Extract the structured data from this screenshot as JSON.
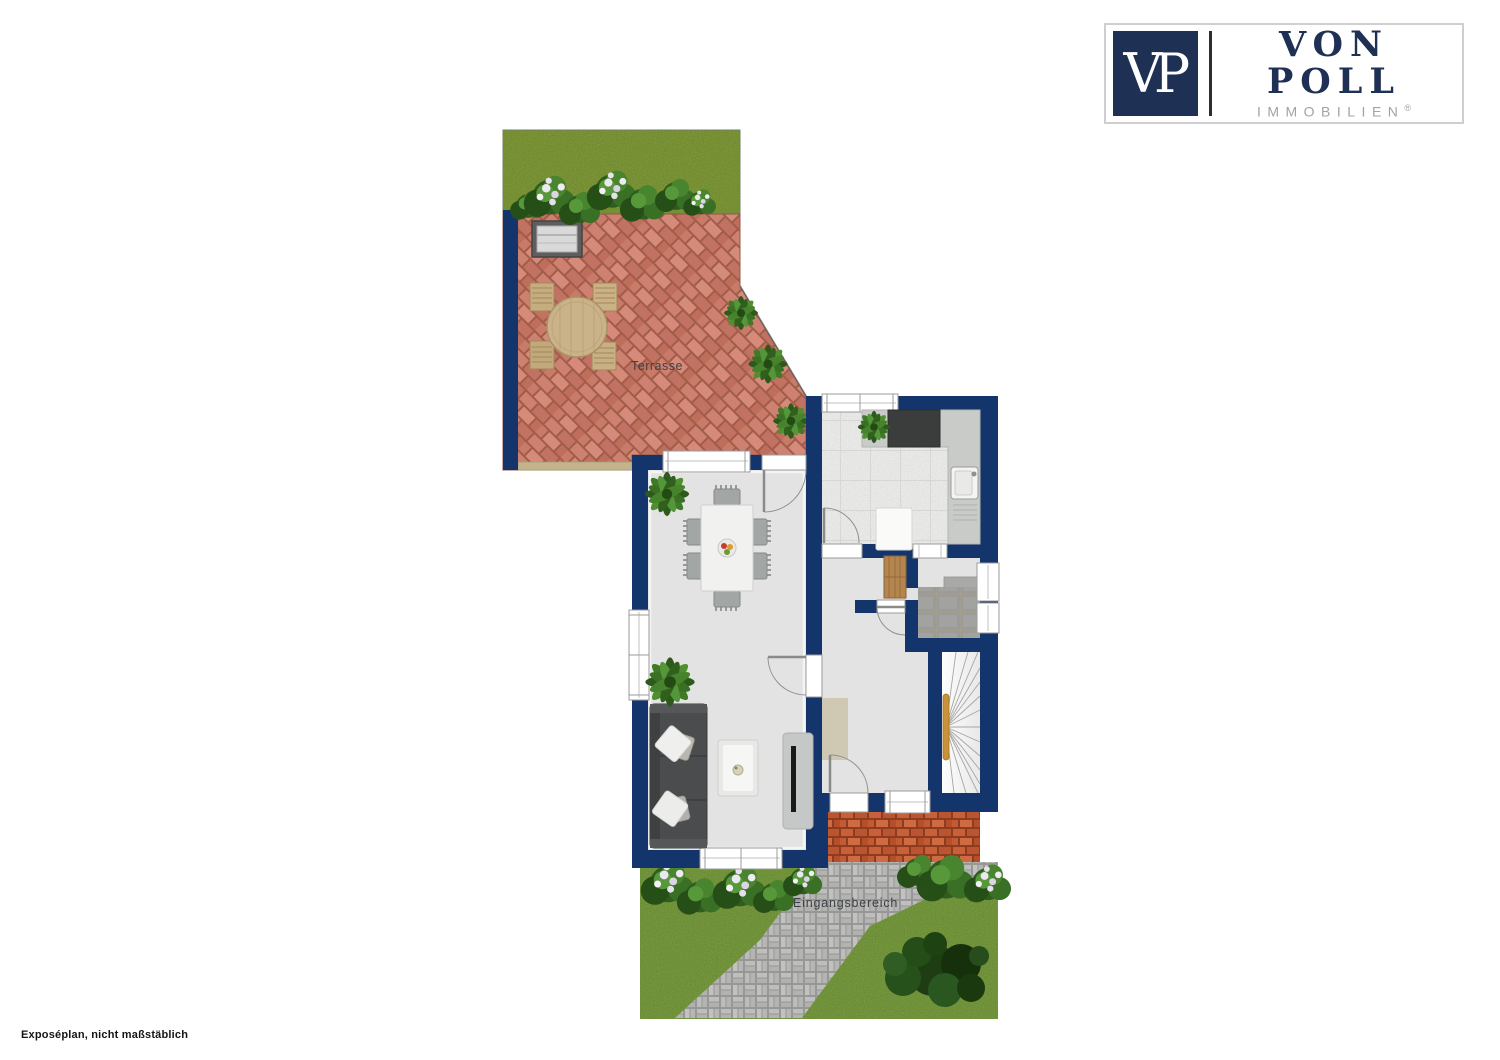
{
  "logo": {
    "monogram": "VP",
    "name": "VON POLL",
    "subtitle": "IMMOBILIEN",
    "registered": "®"
  },
  "plan": {
    "labels": {
      "terrace": "Terrasse",
      "entrance": "Eingangsbereich"
    },
    "caption": "Exposéplan, nicht maßstäblich",
    "colors": {
      "wall": "#14356b",
      "floor": "#e2e3e2",
      "terraceBrick": "#c87c6b",
      "porchBrick": "#c2592f",
      "grassTop": "#95a53e",
      "grassBottom": "#8aa848",
      "path": "#b3b3b1",
      "kitchenTile": "#f6f6f5",
      "vestibuleTile": "#9b9b99",
      "stairRail": "#c8923c",
      "logoNavy": "#1e3054",
      "logoGray": "#a3a3a3",
      "labelInk": "#3d4145"
    }
  }
}
